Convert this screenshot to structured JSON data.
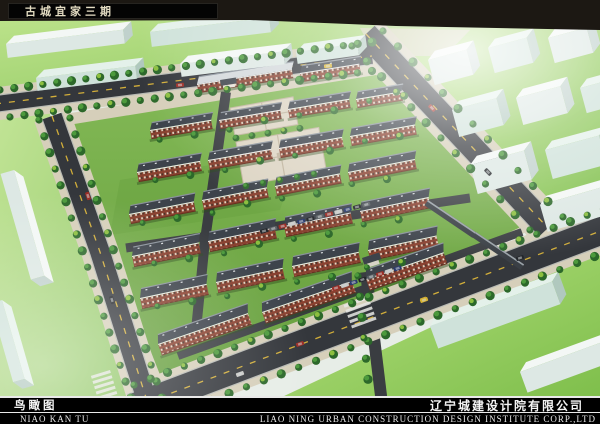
{
  "header": {
    "title": "古城宜家三期"
  },
  "footer": {
    "caption_cn": "鸟瞰图",
    "caption_pinyin": "NIAO KAN TU",
    "company_cn": "辽宁城建设计院有限公司",
    "company_en": "LIAO NING URBAN CONSTRUCTION DESIGN INSTITUTE CORP.,LTD"
  },
  "scene": {
    "type": "aerial-birdseye-architectural-rendering",
    "residential_building_rows": 7,
    "perimeter_roads": 4
  },
  "colors": {
    "top_band": "#1c1813",
    "road": "#34373c",
    "road_edge": "#b9bbb5",
    "road_dash": "#d2ae3a",
    "sidewalk": "#d6cfba",
    "site_lawn_1": "#83b956",
    "site_lawn_2": "#649d3b",
    "context_lawn_1": "#b8e281",
    "context_lawn_2": "#7cbd49",
    "block_top": "#f3f7f5",
    "block_front": "#dde8e4",
    "block_side": "#c0d1cc",
    "block_top2": "#e4f1ea",
    "block_front2": "#cfe2da",
    "block_side2": "#b0c8be",
    "roof": "#3d434b",
    "roof_light": "#8a929b",
    "eave": "#e9ebe8",
    "commercial_roof": "#d3d8db",
    "brick": "#8a4130",
    "brick_dark": "#67301f",
    "window_light": "#e9e2cf",
    "window_dark": "#33302a",
    "tree_dark": "#2c682a",
    "tree_light": "#4c9a3c",
    "bush": "#8cbf3f",
    "plaza": "#ddd5c4",
    "plaza_line": "#c0b49e",
    "internal_road": "#3a3d41",
    "shadow": "#2e4e1e",
    "car_colors": [
      "#23262a",
      "#5a6064",
      "#9c2d26",
      "#c8c9c6",
      "#2a3a6e",
      "#d8b430"
    ]
  }
}
